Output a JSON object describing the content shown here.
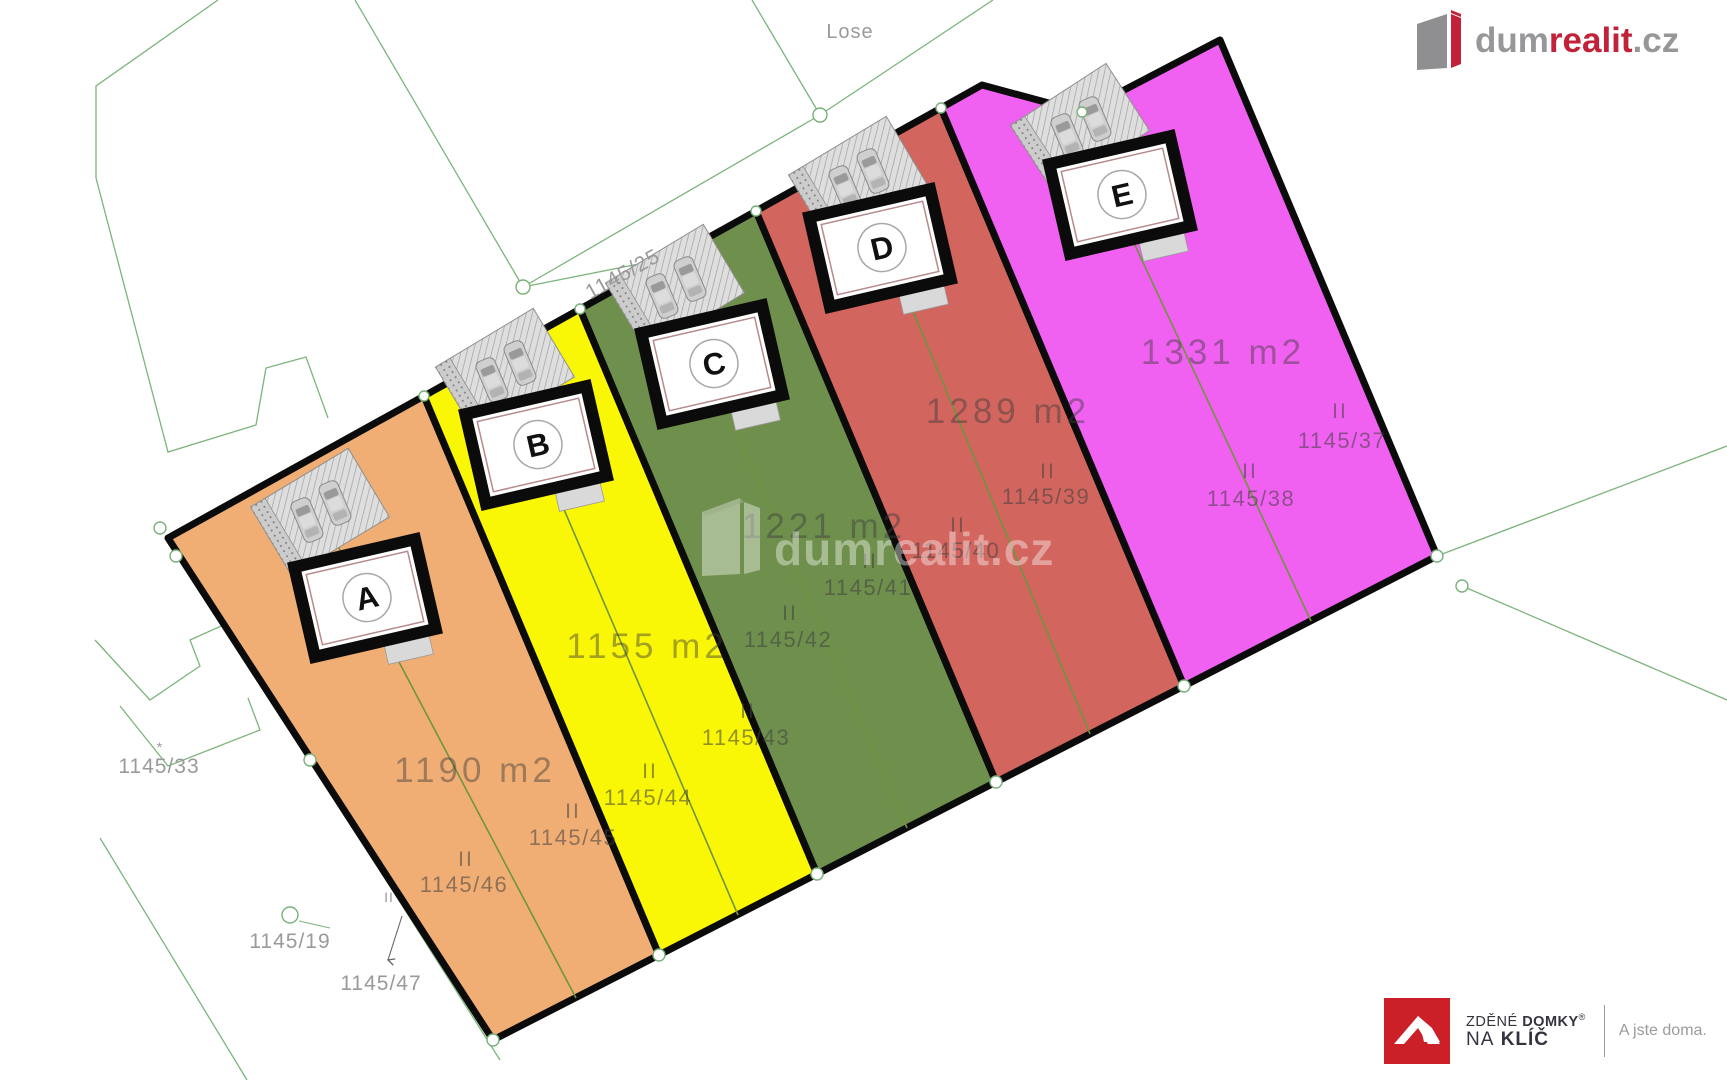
{
  "brand": {
    "logo_part_gray1": "dum",
    "logo_part_red": "realit",
    "logo_part_gray2": ".cz",
    "gray": "#97979a",
    "red": "#c1223a"
  },
  "watermark": {
    "text": "dumrealit.cz"
  },
  "map": {
    "road_label": "Lose",
    "labels": {
      "parcel_25": "1145/25",
      "parcel_33": "1145/33",
      "parcel_19": "1145/19",
      "parcel_47": "1145/47",
      "floors_marker_small": "II",
      "marker_33": "*"
    },
    "line_color": "#7cb47c",
    "axis_color": "#6f9440",
    "parcels": [
      {
        "id": "A",
        "area_label": "1190 m2",
        "color": "#f1ae74",
        "floors": "II",
        "number_right": "1145/45",
        "number_left": "1145/46"
      },
      {
        "id": "B",
        "area_label": "1155 m2",
        "color": "#f9f606",
        "floors": "II",
        "number_right": "1145/43",
        "number_left": "1145/44"
      },
      {
        "id": "C",
        "area_label": "1221 m2",
        "color": "#6f8f4d",
        "floors": "II",
        "number_right": "1145/41",
        "number_left": "1145/42"
      },
      {
        "id": "D",
        "area_label": "1289 m2",
        "color": "#d2655e",
        "floors": "II",
        "number_right": "1145/39",
        "number_left": "1145/40"
      },
      {
        "id": "E",
        "area_label": "1331 m2",
        "color": "#f161f1",
        "floors": "II",
        "number_right": "1145/37",
        "number_left": "1145/38"
      }
    ]
  },
  "footer": {
    "brand_line1_light": "ZDĚNÉ",
    "brand_line1_bold": "DOMKY",
    "reg": "®",
    "brand_line2_light": "NA",
    "brand_line2_bold": "KLÍČ",
    "tagline": "A jste doma."
  }
}
